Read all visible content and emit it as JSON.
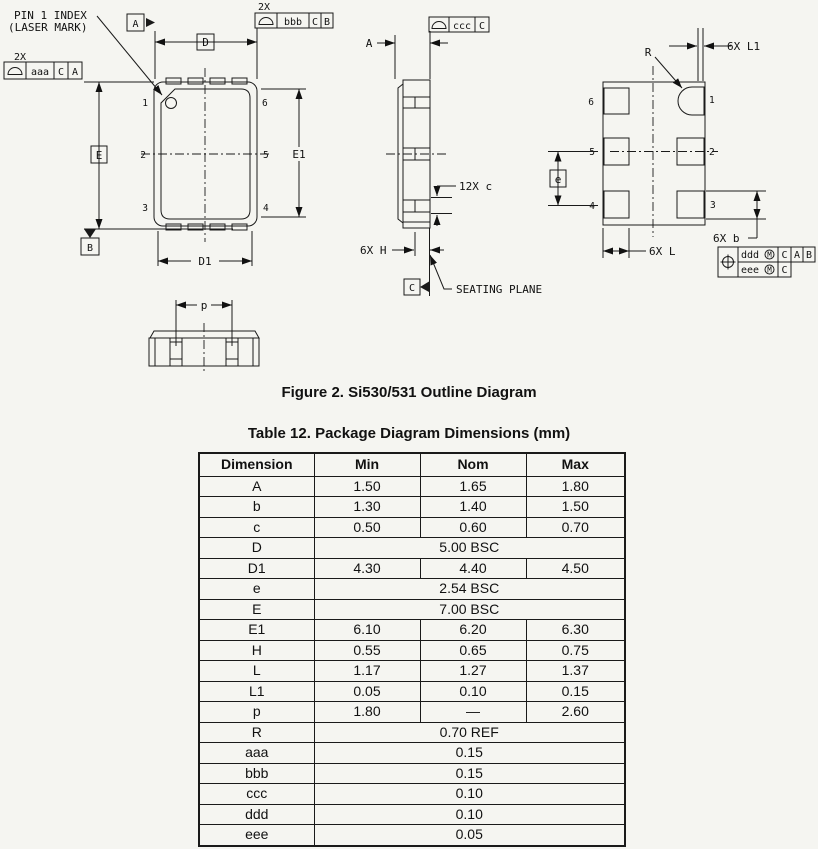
{
  "figure": {
    "caption": "Figure 2. Si530/531 Outline Diagram",
    "labels": {
      "pin1_index_line1": "PIN 1 INDEX",
      "pin1_index_line2": "(LASER MARK)",
      "qty_2x_left": "2X",
      "qty_2x_top": "2X",
      "fcf_aaa": {
        "tol": "aaa",
        "datum_1": "C",
        "datum_2": "A"
      },
      "fcf_bbb": {
        "tol": "bbb",
        "datum_1": "C",
        "datum_2": "B"
      },
      "fcf_ccc": {
        "tol": "ccc",
        "datum_1": "C"
      },
      "fcf_position": {
        "row1_tol": "ddd",
        "row1_mod": "M",
        "row1_d1": "C",
        "row1_d2": "A",
        "row1_d3": "B",
        "row2_tol": "eee",
        "row2_mod": "M",
        "row2_d1": "C"
      },
      "datum_a": "A",
      "datum_b": "B",
      "datum_c": "C",
      "dim_D": "D",
      "dim_D1": "D1",
      "dim_E": "E",
      "dim_E1": "E1",
      "dim_A": "A",
      "dim_e": "e",
      "dim_p": "p",
      "dim_R": "R",
      "dim_12x_c": "12X c",
      "dim_6x_H": "6X H",
      "dim_6x_L1": "6X L1",
      "dim_6x_L": "6X L",
      "dim_6x_b": "6X b",
      "seating_plane": "SEATING PLANE"
    },
    "pins": {
      "p1": "1",
      "p2": "2",
      "p3": "3",
      "p4": "4",
      "p5": "5",
      "p6": "6"
    }
  },
  "table": {
    "title": "Table 12. Package Diagram Dimensions (mm)",
    "columns": [
      "Dimension",
      "Min",
      "Nom",
      "Max"
    ],
    "rows": [
      {
        "dimension": "A",
        "min": "1.50",
        "nom": "1.65",
        "max": "1.80"
      },
      {
        "dimension": "b",
        "min": "1.30",
        "nom": "1.40",
        "max": "1.50"
      },
      {
        "dimension": "c",
        "min": "0.50",
        "nom": "0.60",
        "max": "0.70"
      },
      {
        "dimension": "D",
        "span": "5.00 BSC"
      },
      {
        "dimension": "D1",
        "min": "4.30",
        "nom": "4.40",
        "max": "4.50"
      },
      {
        "dimension": "e",
        "span": "2.54 BSC"
      },
      {
        "dimension": "E",
        "span": "7.00 BSC"
      },
      {
        "dimension": "E1",
        "min": "6.10",
        "nom": "6.20",
        "max": "6.30"
      },
      {
        "dimension": "H",
        "min": "0.55",
        "nom": "0.65",
        "max": "0.75"
      },
      {
        "dimension": "L",
        "min": "1.17",
        "nom": "1.27",
        "max": "1.37"
      },
      {
        "dimension": "L1",
        "min": "0.05",
        "nom": "0.10",
        "max": "0.15"
      },
      {
        "dimension": "p",
        "min": "1.80",
        "nom": "—",
        "max": "2.60"
      },
      {
        "dimension": "R",
        "span": "0.70 REF"
      },
      {
        "dimension": "aaa",
        "span": "0.15"
      },
      {
        "dimension": "bbb",
        "span": "0.15"
      },
      {
        "dimension": "ccc",
        "span": "0.10"
      },
      {
        "dimension": "ddd",
        "span": "0.10"
      },
      {
        "dimension": "eee",
        "span": "0.05"
      }
    ]
  }
}
